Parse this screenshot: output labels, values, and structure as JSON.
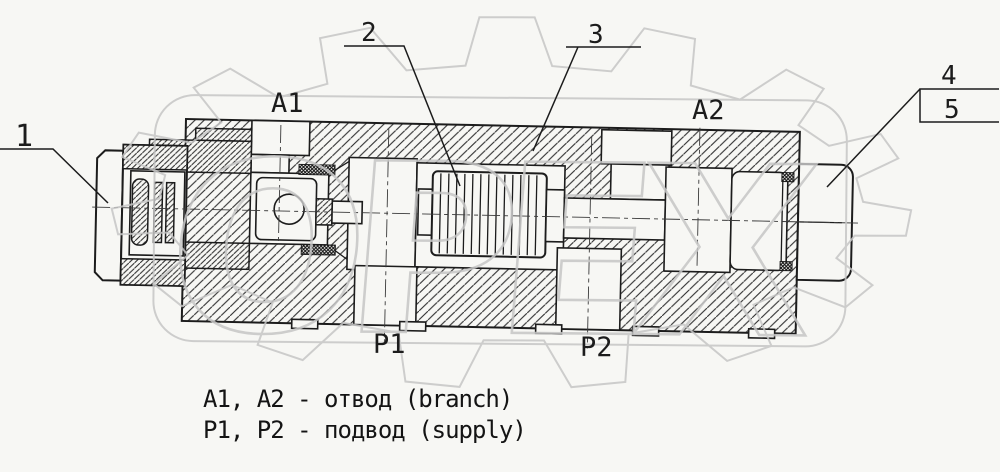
{
  "diagram": {
    "callouts": {
      "c1": "1",
      "c2": "2",
      "c3": "3",
      "c4": "4",
      "c5": "5"
    },
    "ports": {
      "a1": "A1",
      "a2": "A2",
      "p1": "P1",
      "p2": "P2"
    },
    "legend": {
      "line1": "A1, A2 - отвод (branch)",
      "line2": "P1, P2 - подвод (supply)"
    },
    "watermark": {
      "text": "ОРЕХ"
    },
    "colors": {
      "ink": "#1c1c1c",
      "paper": "#f7f7f4",
      "watermark": "#c6c6c6"
    }
  }
}
